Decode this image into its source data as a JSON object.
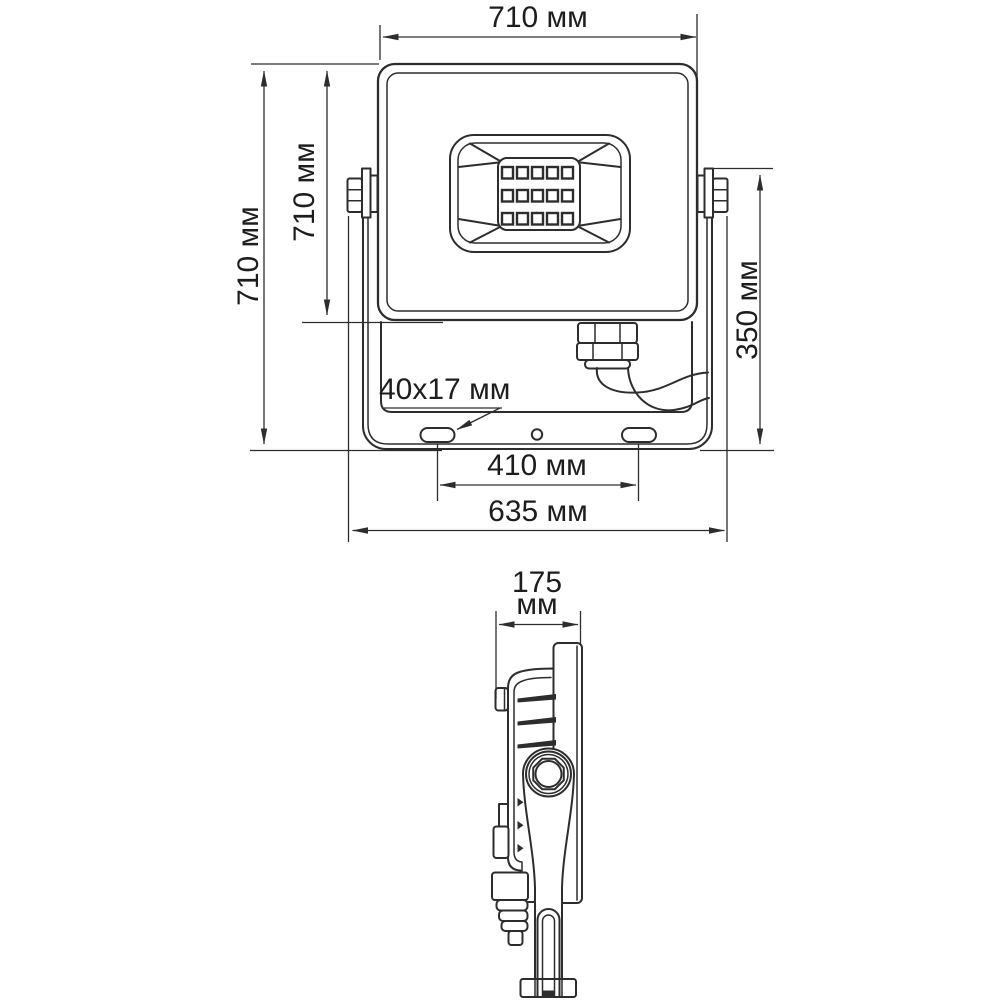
{
  "drawing": {
    "background_color": "#ffffff",
    "line_color": "#2d2d2d",
    "views": {
      "front": {
        "dims": {
          "top_width": "710 мм",
          "overall_height": "710 мм",
          "body_height": "710 мм",
          "bracket_height": "350 мм",
          "slot_size": "40x17 мм",
          "slot_spacing": "410 мм",
          "base_width": "635 мм"
        },
        "led_chips": {
          "rows": 3,
          "columns": 5,
          "count": 15
        }
      },
      "side": {
        "dims": {
          "depth_value": "175",
          "depth_unit": "мм"
        }
      }
    }
  }
}
